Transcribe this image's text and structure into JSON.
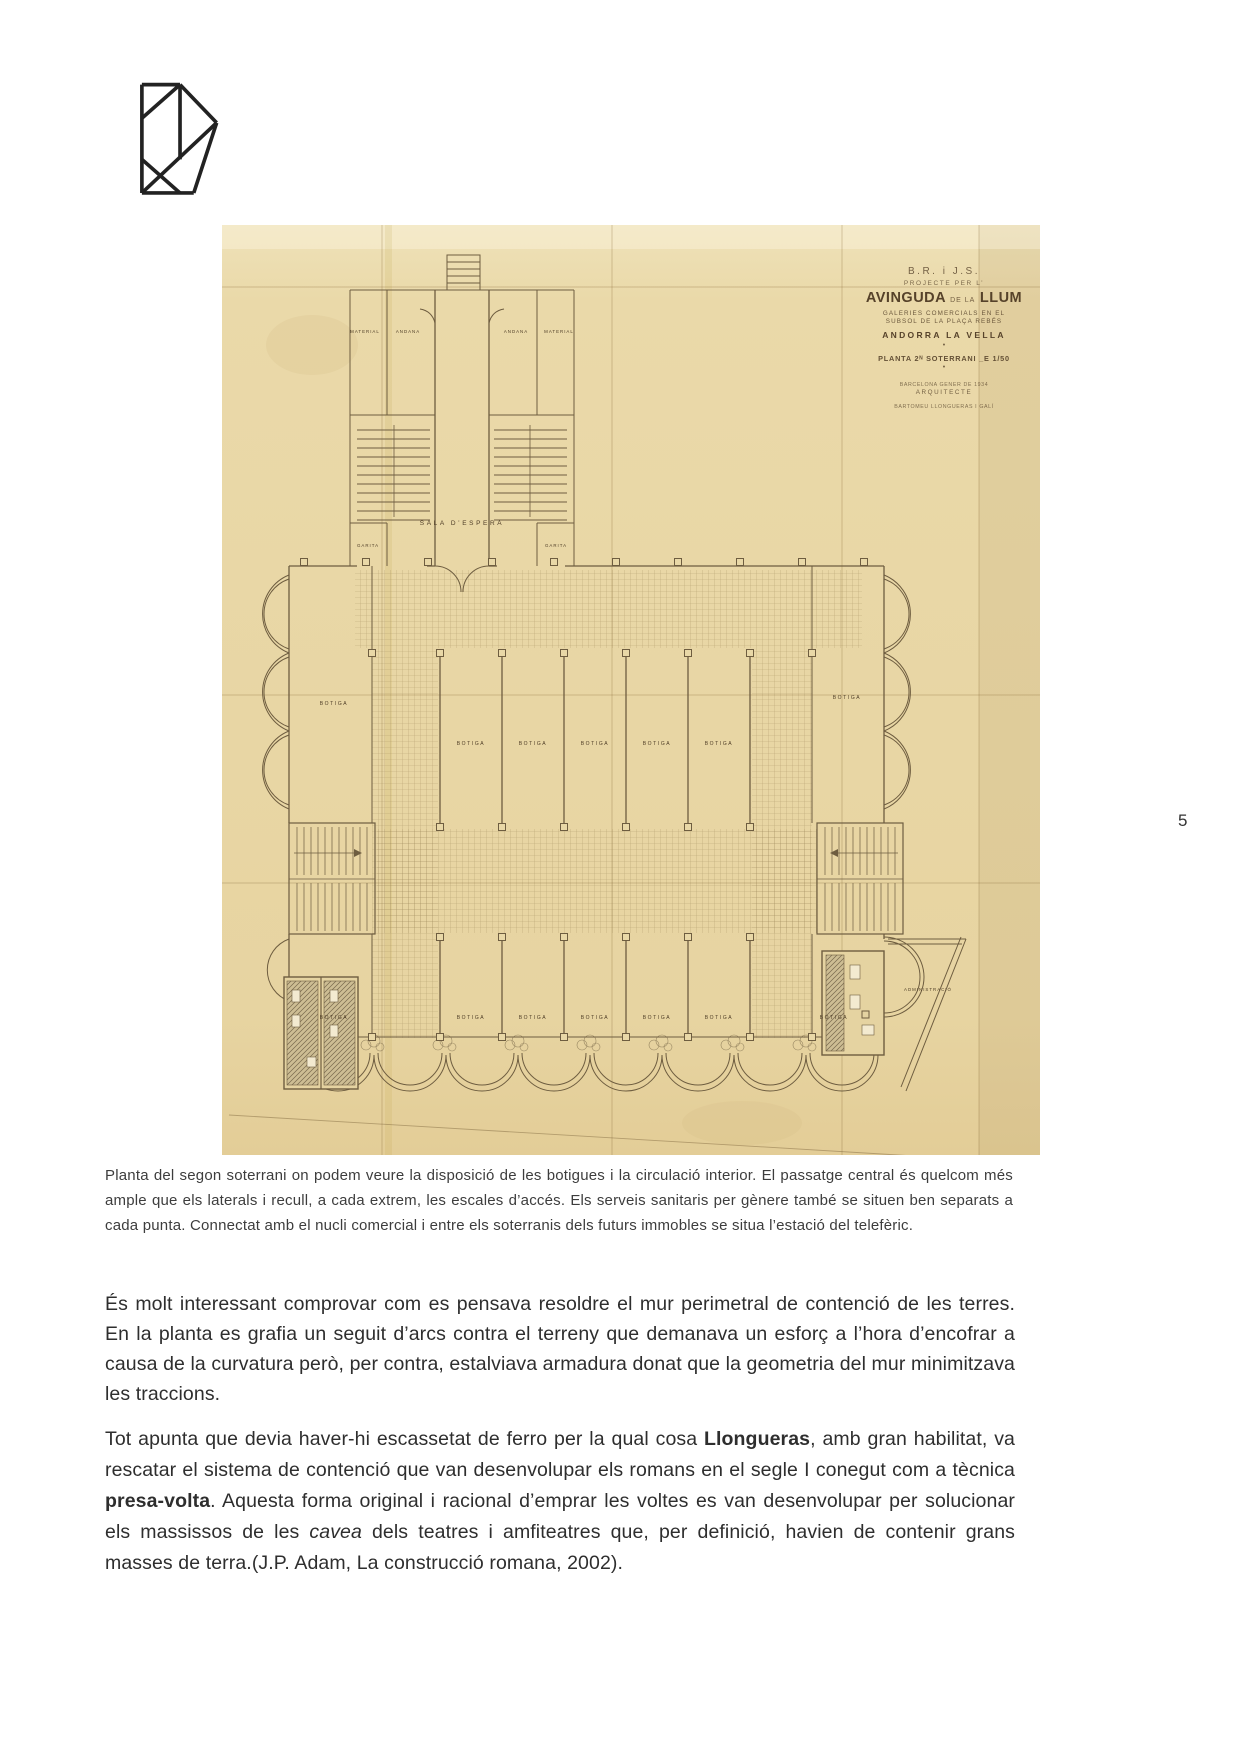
{
  "page": {
    "number": "5"
  },
  "figure": {
    "title_block": {
      "line1": "B.R. i J.S.",
      "line2": "PROJECTE PER L’",
      "line3_big1": "AVINGUDA",
      "line3_small": "DE LA",
      "line3_big2": "LLUM",
      "line4": "GALERIES COMERCIALS EN EL",
      "line5": "SUBSOL DE LA PLAÇA REBÉS",
      "line6": "ANDORRA LA VELLA",
      "dot": "•",
      "line7": "PLANTA 2ᴺ SOTERRANI _E 1/50",
      "line8": "BARCELONA GENER DE 1934",
      "line9": "ARQUITECTE",
      "line10": "BARTOMEU LLONGUERAS I GALÍ"
    },
    "plan_labels": {
      "material": "MATERIAL",
      "andana": "ANDANA",
      "garita": "GARITA",
      "sala_espera": "SALA  D’ESPERA",
      "botiga": "BOTIGA",
      "administracio": "ADMINISTRACIÓ"
    }
  },
  "caption": "Planta del segon soterrani on podem veure la disposició de les botigues i la circulació interior. El passatge central és quelcom més ample que els laterals i recull, a cada extrem, les escales d’accés. Els serveis sanitaris per gènere també se situen ben separats a cada punta. Connectat amb el nucli comercial i entre els soterranis dels futurs immobles se situa l’estació del telefèric.",
  "paragraphs": {
    "p1": "És molt interessant comprovar com es pensava resoldre el mur perimetral de contenció de les terres. En la planta es grafia un seguit d’arcs contra el terreny que demanava un esforç a l’hora d’encofrar a causa de la curvatura però, per contra, estalviava armadura donat que la geometria del mur minimitzava les traccions.",
    "p2": {
      "t1": "Tot apunta que devia haver-hi escassetat de ferro per la qual cosa ",
      "b1": "Llongueras",
      "t2": ", amb gran habilitat, va rescatar el sistema de contenció que van desenvolupar els romans en el segle I conegut com a tècnica ",
      "b2": "presa-volta",
      "t3": ". Aquesta forma original i racional d’emprar les voltes es van desenvolupar per solucionar els massissos de les ",
      "i1": "cavea",
      "t4": " dels teatres i amfiteatres que, per definició, havien de contenir grans masses de terra.(J.P. Adam, La construcció romana, 2002)."
    }
  },
  "colors": {
    "paper": "#e9d8a7",
    "plan_ink": "#6e5d40",
    "logo_ink": "#222222",
    "body_text": "#2e2e2e"
  }
}
